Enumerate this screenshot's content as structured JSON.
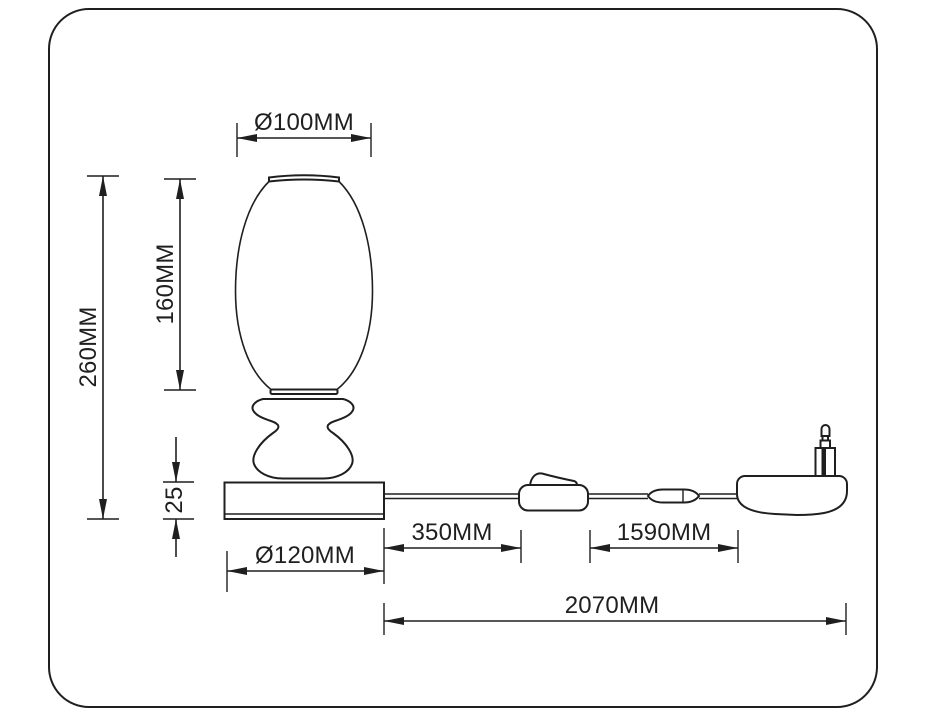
{
  "drawing": {
    "product": "Table lamp technical dimension drawing",
    "parts": [
      "lamp-shade",
      "stem",
      "base",
      "power-cord",
      "inline-switch",
      "cord-connector",
      "power-plug"
    ],
    "colors": {
      "line": "#1f1f1f",
      "background": "#ffffff"
    }
  },
  "dimensions": {
    "shade_diameter": "Ø100MM",
    "shade_height": "160MM",
    "total_height": "260MM",
    "base_height": "25",
    "base_diameter": "Ø120MM",
    "base_to_switch": "350MM",
    "switch_to_plug": "1590MM",
    "total_cord_run": "2070MM"
  }
}
